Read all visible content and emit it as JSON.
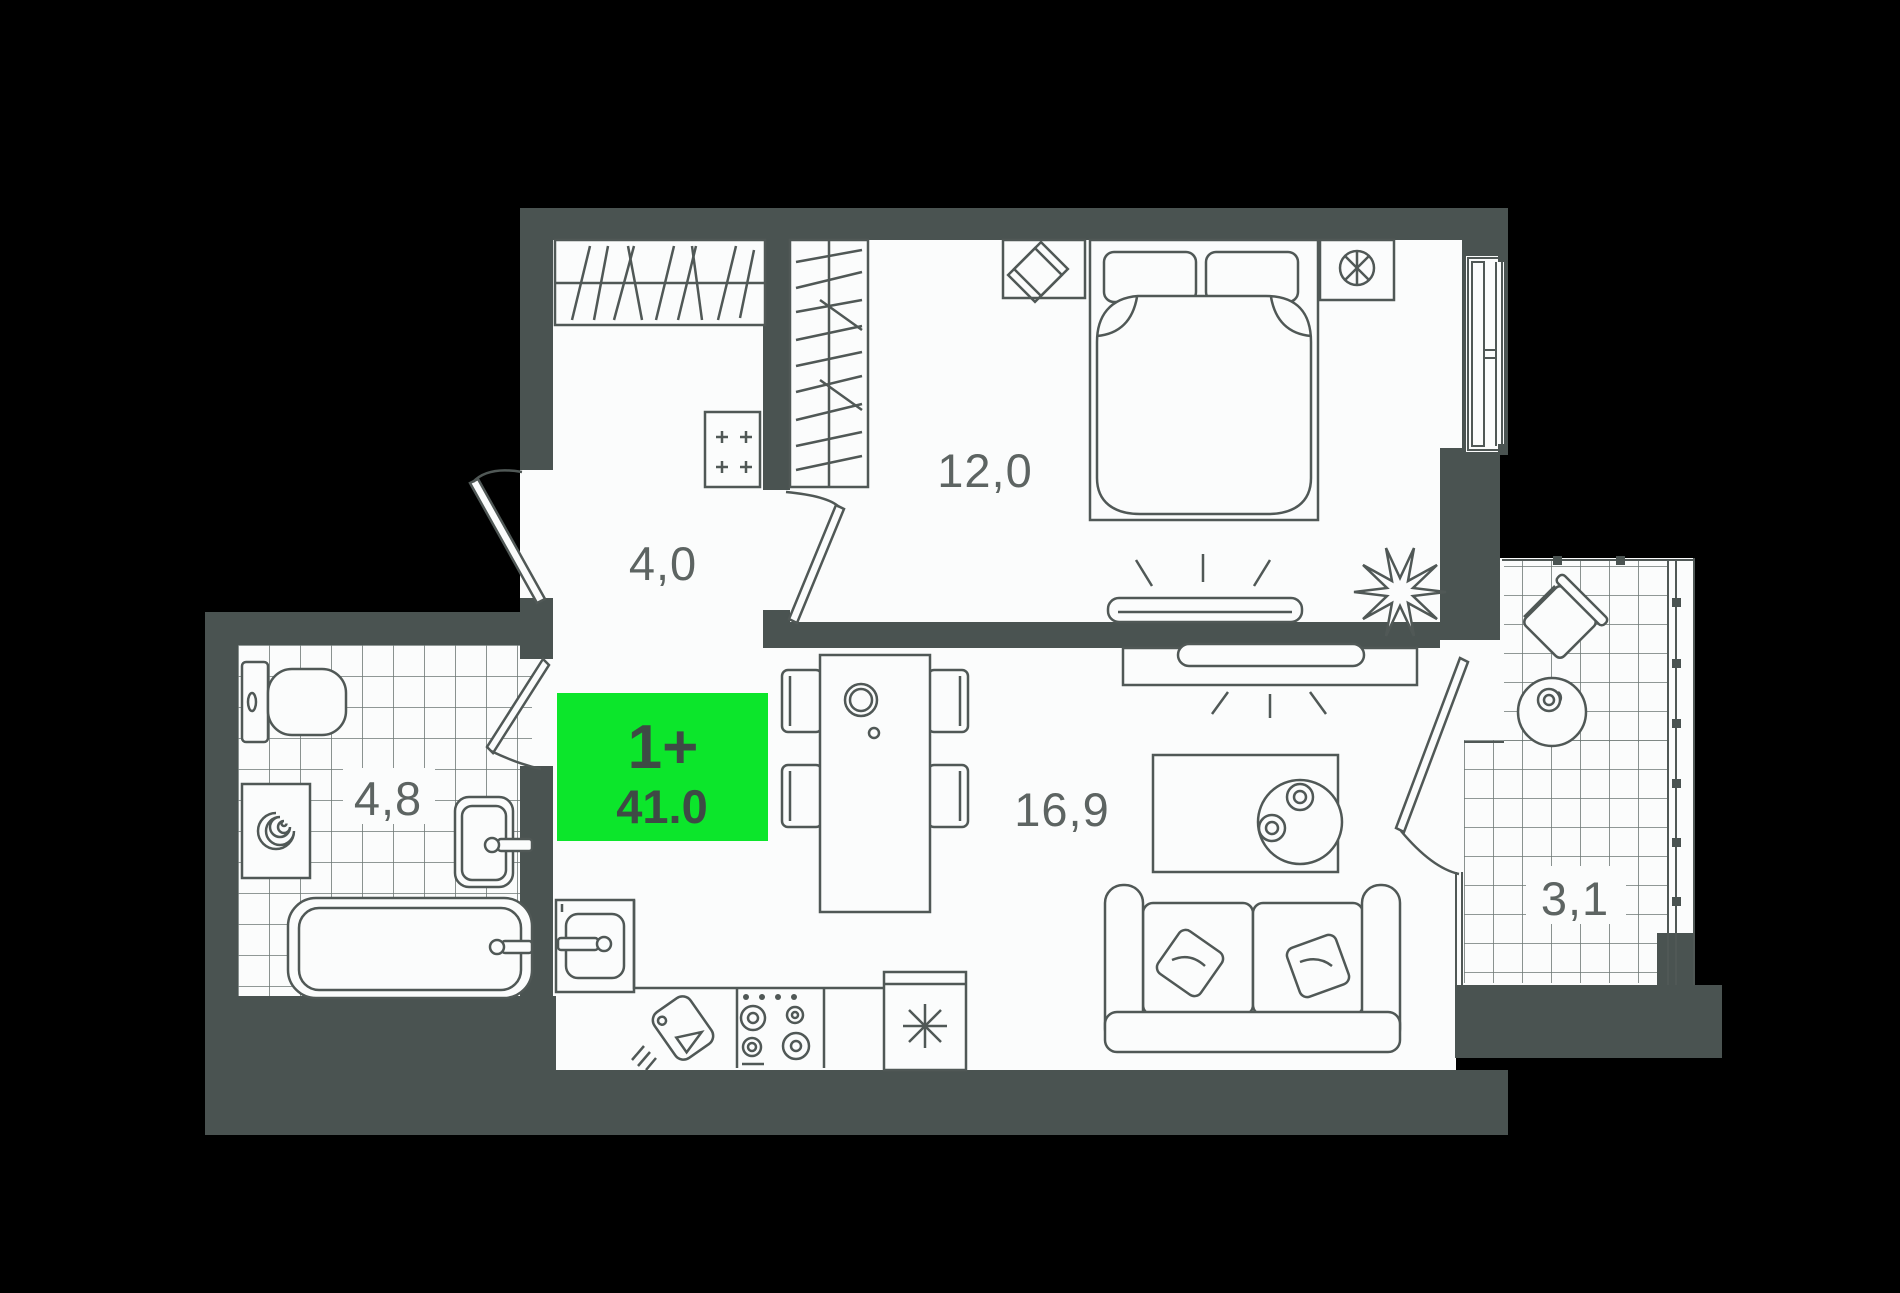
{
  "plan": {
    "badge": {
      "rooms_label": "1+",
      "total_area": "41.0",
      "bg_color": "#0ce62b",
      "text_color": "#3e4a45"
    },
    "rooms": [
      {
        "id": "hallway",
        "area_label": "4,0"
      },
      {
        "id": "bedroom",
        "area_label": "12,0"
      },
      {
        "id": "bathroom",
        "area_label": "4,8"
      },
      {
        "id": "living-kitchen",
        "area_label": "16,9"
      },
      {
        "id": "balcony",
        "area_label": "3,1"
      }
    ],
    "furniture_icons": [
      "wardrobe-icon",
      "bed-icon",
      "nightstand-icon",
      "picture-frame-icon",
      "fan-icon",
      "tv-icon",
      "plant-icon",
      "dining-table-icon",
      "chair-icon",
      "decanter-icon",
      "kitchen-sink-icon",
      "cutting-board-icon",
      "stove-icon",
      "fridge-snowflake-icon",
      "sofa-icon",
      "coffee-table-icon",
      "toilet-icon",
      "washing-machine-icon",
      "bath-sink-icon",
      "bathtub-icon",
      "balcony-chair-icon",
      "balcony-table-icon",
      "electric-panel-icon",
      "door-swing-icon",
      "window-icon"
    ],
    "colors": {
      "background": "#000000",
      "walls": "#4a5351",
      "floor": "#fbfcfc",
      "line": "#505856",
      "tile_line": "#6d7774",
      "label": "#5d6462"
    }
  }
}
